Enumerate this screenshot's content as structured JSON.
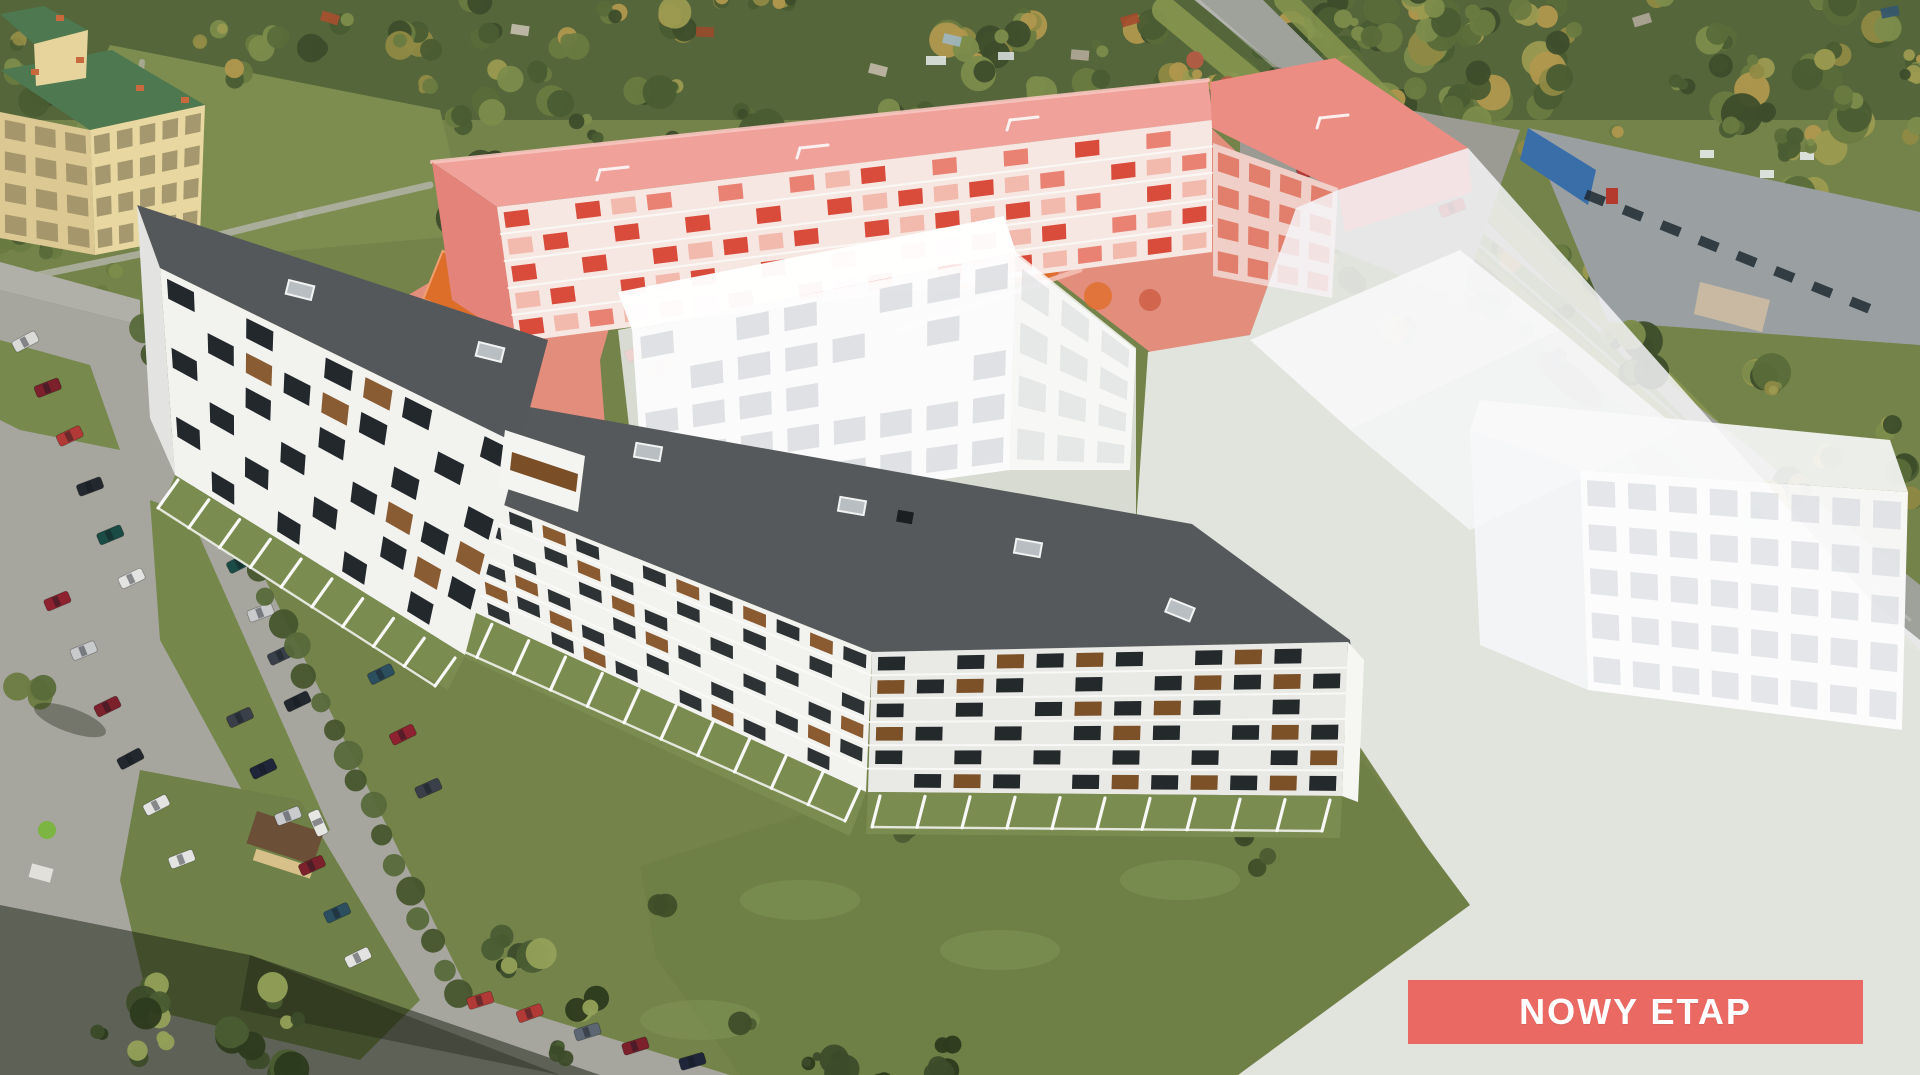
{
  "badge": {
    "label": "NOWY ETAP",
    "background": "#ea6a63",
    "text_color": "#ffffff"
  },
  "colors": {
    "highlight_roof": "#efa19a",
    "highlight_facade": "#f7e7e2",
    "highlight_window": "#d94c3b",
    "highlight_ground": "#e98d80",
    "roof_dark": "#56595b",
    "facade_white": "#f2f2ef",
    "ghost_white": "#f4f5f7",
    "grass": "#74834a",
    "asphalt": "#a6a69f",
    "tree_dark": "#3c4b2a",
    "tree_light": "#7e8d4d",
    "playground_orange": "#df6e2b"
  }
}
